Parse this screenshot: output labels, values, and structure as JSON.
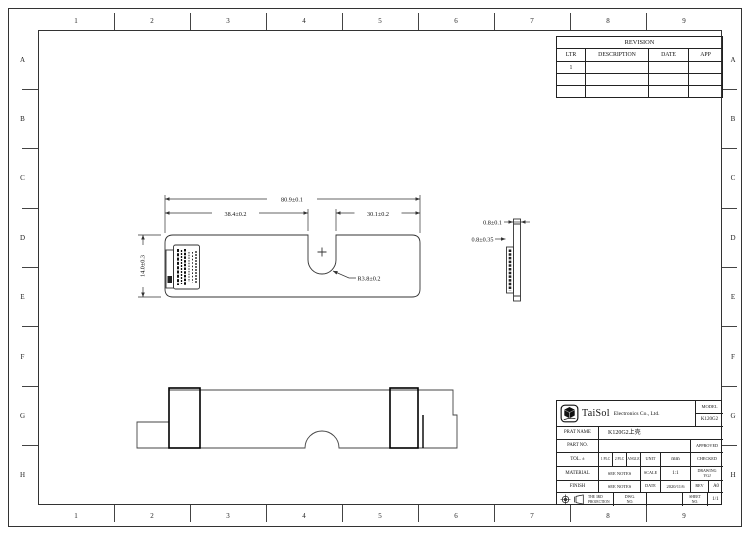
{
  "frame": {
    "cols": [
      "1",
      "2",
      "3",
      "4",
      "5",
      "6",
      "7",
      "8",
      "9"
    ],
    "rows": [
      "A",
      "B",
      "C",
      "D",
      "E",
      "F",
      "G",
      "H"
    ]
  },
  "revision": {
    "title": "REVISION",
    "headers": [
      "LTR",
      "DESCRIPTION",
      "DATE",
      "APP"
    ],
    "rows": [
      [
        "1",
        "",
        "",
        ""
      ],
      [
        "",
        "",
        "",
        ""
      ],
      [
        "",
        "",
        "",
        ""
      ]
    ]
  },
  "drawing": {
    "dim_overall_width": "80.9±0.1",
    "dim_left_width": "38.4±0.2",
    "dim_right_width": "30.1±0.2",
    "dim_height": "14.0±0.3",
    "dim_notch_radius": "R3.8±0.2",
    "dim_thickness": "0.8±0.1",
    "dim_inner_thickness": "0.8±0.35"
  },
  "title_block": {
    "company_name": "TaiSol",
    "company_suffix": "Electronics Co., Ltd.",
    "model_label": "MODEL",
    "model_value": "K120G2",
    "part_name_label": "PRAT NAME",
    "part_name_value": "K120G2上壳",
    "part_no_label": "PART NO.",
    "approved_label": "APPROVED",
    "tol_label": "TOL. ±",
    "tol_plc1": "1 PLC",
    "tol_plc2": "2 PLC",
    "tol_angle": "ANGLE",
    "unit_label": "UNIT",
    "unit_value": "mm",
    "checked_label": "CHECKED",
    "material_label": "MATERIAL",
    "material_value": "SEE NOTES",
    "scale_label": "SCALE",
    "scale_value": "1:1",
    "drawing_label": "DRAWING",
    "drawing_value": "YGJ",
    "finish_label": "FINISH",
    "finish_value": "SEE NOTES",
    "date_label": "DATE",
    "date_value": "2020/11/6",
    "rev_label": "REV",
    "rev_value": "A0",
    "projection_label": "THE 3RD PROJECTION",
    "dwg_no_label": "DWG. NO.",
    "sheet_label": "SHEET NO.",
    "sheet_value": "1/1"
  }
}
